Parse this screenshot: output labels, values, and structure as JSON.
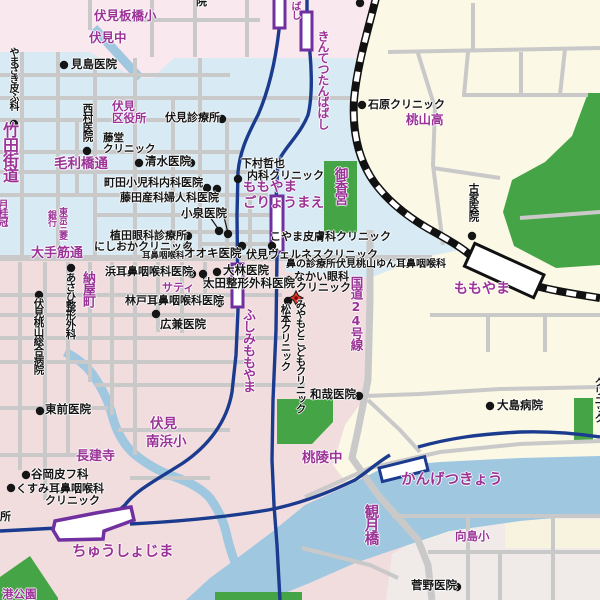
{
  "map": {
    "colors": {
      "purple_text": "#9B3397",
      "black_text": "#151515",
      "residential_blue": "#D8EAF3",
      "residential_pink": "#F1DDDE",
      "pink_light": "#F9E8EE",
      "cream": "#FBF8E6",
      "mukaijima_pale": "#F0EBE9",
      "water": "#9FC7E0",
      "park_green": "#45A546",
      "street_gray": "#C9C9C9",
      "railway_blue": "#1B3B8F",
      "station_purple": "#7030A0",
      "jr_black": "#111111",
      "marker_red": "#E5372E"
    },
    "marker": {
      "x": 296,
      "y": 298,
      "label": "destination"
    },
    "extra_dots": [
      [
        360,
        3
      ],
      [
        191,
        163
      ],
      [
        217,
        189
      ],
      [
        228,
        234
      ],
      [
        203,
        274
      ]
    ],
    "labels": [
      {
        "n": "fushimi-itabashi-elementary",
        "t": "伏見板橋小",
        "x": 94,
        "y": 10,
        "s": 12.5,
        "c": "p"
      },
      {
        "n": "fushimi-junior-high",
        "t": "伏見中",
        "x": 89,
        "y": 32,
        "s": 12.5,
        "c": "p"
      },
      {
        "n": "kintetsu-tambabashi-station",
        "t": "きんてつたんばばし",
        "x": 317,
        "y": 30,
        "s": 12,
        "c": "p",
        "v": 1
      },
      {
        "n": "tambabashi-station-partial",
        "t": "ばし",
        "x": 289,
        "y": 1,
        "s": 10,
        "c": "p",
        "v": 1
      },
      {
        "n": "momoyama-high-school",
        "t": "桃山高",
        "x": 406,
        "y": 114,
        "s": 12.5,
        "c": "p"
      },
      {
        "n": "takeda-kaido",
        "t": "竹田街道",
        "x": 1,
        "y": 122,
        "s": 16,
        "c": "p",
        "v": 1
      },
      {
        "n": "gekkeikan",
        "t": "月桂冠",
        "x": -4,
        "y": 199,
        "s": 10,
        "c": "p",
        "v": 1
      },
      {
        "n": "mourihashi-dori",
        "t": "毛利橋通",
        "x": 54,
        "y": 158,
        "s": 13.5,
        "c": "p"
      },
      {
        "n": "tokyo-mitsubishi-bank-line1",
        "t": "東京三菱",
        "x": 57,
        "y": 207,
        "s": 9,
        "c": "p",
        "v": 1
      },
      {
        "n": "tokyo-mitsubishi-bank-line2",
        "t": "銀行",
        "x": 46,
        "y": 210,
        "s": 9,
        "c": "p",
        "v": 1
      },
      {
        "n": "otesuji-dori",
        "t": "大手筋通",
        "x": 31,
        "y": 247,
        "s": 13,
        "c": "p"
      },
      {
        "n": "nayamachi",
        "t": "納屋町",
        "x": 81,
        "y": 271,
        "s": 13,
        "c": "p",
        "v": 1
      },
      {
        "n": "saty",
        "t": "サティ",
        "x": 162,
        "y": 282,
        "s": 11,
        "c": "p"
      },
      {
        "n": "fushimi-momoyama-station",
        "t": "ふしみももやま",
        "x": 241,
        "y": 308,
        "s": 13,
        "c": "p",
        "v": 1
      },
      {
        "n": "momoyama-goryomae-station-line1",
        "t": "ももやま",
        "x": 243,
        "y": 181,
        "s": 13.5,
        "c": "p"
      },
      {
        "n": "momoyama-goryomae-station-line2",
        "t": "ごりょうまえ",
        "x": 243,
        "y": 197,
        "s": 13.5,
        "c": "p"
      },
      {
        "n": "gokonomiya-shrine",
        "t": "御香宮",
        "x": 332,
        "y": 167,
        "s": 13.5,
        "c": "p",
        "v": 1
      },
      {
        "n": "route-24",
        "t": "国道24号線",
        "x": 349,
        "y": 276,
        "s": 12.5,
        "c": "p",
        "v": 1
      },
      {
        "n": "jr-momoyama-station",
        "t": "ももやま",
        "x": 454,
        "y": 282,
        "s": 14,
        "c": "p"
      },
      {
        "n": "toryo-junior-high",
        "t": "桃陵中",
        "x": 302,
        "y": 452,
        "s": 13.5,
        "c": "p"
      },
      {
        "n": "fushimi-minamihama-elementary-line1",
        "t": "伏見",
        "x": 150,
        "y": 418,
        "s": 13.5,
        "c": "p"
      },
      {
        "n": "fushimi-minamihama-elementary-line2",
        "t": "南浜小",
        "x": 146,
        "y": 436,
        "s": 13.5,
        "c": "p"
      },
      {
        "n": "chokenji-temple",
        "t": "長建寺",
        "x": 76,
        "y": 450,
        "s": 13,
        "c": "p"
      },
      {
        "n": "chushojima-station",
        "t": "ちゅうしょじま",
        "x": 72,
        "y": 545,
        "s": 14.5,
        "c": "p"
      },
      {
        "n": "kangetsukyo-station",
        "t": "かんげつきょう",
        "x": 401,
        "y": 473,
        "s": 14.5,
        "c": "p"
      },
      {
        "n": "kangetsu-bridge",
        "t": "観月橋",
        "x": 363,
        "y": 504,
        "s": 14.5,
        "c": "p",
        "v": 1
      },
      {
        "n": "mukaijima-elementary",
        "t": "向島小",
        "x": 455,
        "y": 531,
        "s": 11.5,
        "c": "p"
      },
      {
        "n": "minato-park",
        "t": "港公園",
        "x": 2,
        "y": 589,
        "s": 11.5,
        "c": "p"
      },
      {
        "n": "fushimi-ward-office-line1",
        "t": "伏見",
        "x": 112,
        "y": 101,
        "s": 11.5,
        "c": "p"
      },
      {
        "n": "fushimi-ward-office-line2",
        "t": "区役所",
        "x": 112,
        "y": 113,
        "s": 11.5,
        "c": "p"
      },
      {
        "n": "yamazaki-hifuka",
        "t": "やまざき皮ふ科",
        "x": 7,
        "y": 47,
        "s": 10,
        "c": "k",
        "v": 1,
        "dot": [
          14,
          124
        ]
      },
      {
        "n": "mishima-clinic",
        "t": "見島医院",
        "x": 71,
        "y": 59,
        "s": 11.5,
        "c": "k",
        "dot": [
          64,
          65
        ]
      },
      {
        "n": "nishimura-clinic",
        "t": "西村医院",
        "x": 82,
        "y": 103,
        "s": 10.5,
        "c": "k",
        "v": 1,
        "dot": [
          87,
          151
        ]
      },
      {
        "n": "fushimi-clinic",
        "t": "伏見診療所",
        "x": 165,
        "y": 112,
        "s": 11,
        "c": "k",
        "dot": [
          222,
          119
        ]
      },
      {
        "n": "todo-clinic-line1",
        "t": "藤堂",
        "x": 103,
        "y": 133,
        "s": 10.5,
        "c": "k"
      },
      {
        "n": "todo-clinic-line2",
        "t": "クリニック",
        "x": 103,
        "y": 144,
        "s": 10.5,
        "c": "k"
      },
      {
        "n": "shimizu-clinic",
        "t": "清水医院",
        "x": 145,
        "y": 156,
        "s": 11.5,
        "c": "k",
        "dot": [
          139,
          163
        ]
      },
      {
        "n": "machida-clinic",
        "t": "町田小児科内科医院",
        "x": 104,
        "y": 177,
        "s": 11,
        "c": "k",
        "dot": [
          207,
          188
        ]
      },
      {
        "n": "fujita-clinic",
        "t": "藤田産科婦人科医院",
        "x": 120,
        "y": 192,
        "s": 11,
        "c": "k"
      },
      {
        "n": "koizumi-clinic",
        "t": "小泉医院",
        "x": 181,
        "y": 208,
        "s": 11.5,
        "c": "k",
        "dot": [
          219,
          231
        ]
      },
      {
        "n": "ueda-eye-clinic",
        "t": "植田眼科診療所",
        "x": 110,
        "y": 230,
        "s": 11,
        "c": "k",
        "dot": [
          188,
          236
        ]
      },
      {
        "n": "nishioka-clinic",
        "t": "にしおかクリニック",
        "x": 94,
        "y": 241,
        "s": 11,
        "c": "k",
        "dot": [
          187,
          246
        ]
      },
      {
        "n": "ohki-ent-line1",
        "t": "耳鼻咽喉科",
        "x": 142,
        "y": 252,
        "s": 8.5,
        "c": "k"
      },
      {
        "n": "ohki-ent-line2",
        "t": "オオキ医院",
        "x": 184,
        "y": 248,
        "s": 11.5,
        "c": "k"
      },
      {
        "n": "shimomura-clinic-line1",
        "t": "下村哲也",
        "x": 241,
        "y": 158,
        "s": 11,
        "c": "k",
        "dot": [
          238,
          179
        ]
      },
      {
        "n": "shimomura-clinic-line2",
        "t": "内科クリニック",
        "x": 247,
        "y": 170,
        "s": 11,
        "c": "k"
      },
      {
        "n": "koyama-derma-clinic",
        "t": "こやま皮膚科クリニック",
        "x": 270,
        "y": 231,
        "s": 11,
        "c": "k",
        "dot": [
          272,
          246
        ]
      },
      {
        "n": "fushimi-wellness-clinic",
        "t": "伏見ヴェルネスクリニック",
        "x": 246,
        "y": 249,
        "s": 11,
        "c": "k",
        "dot": [
          242,
          246
        ]
      },
      {
        "n": "hana-no-shinryojo-yun-ent",
        "t": "鼻の診療所伏見桃山ゆん耳鼻咽喉科",
        "x": 286,
        "y": 260,
        "s": 10,
        "c": "k"
      },
      {
        "n": "nakai-eye-line1",
        "t": "なかい眼科",
        "x": 294,
        "y": 271,
        "s": 11,
        "c": "k",
        "dot": [
          289,
          280
        ]
      },
      {
        "n": "nakai-eye-line2",
        "t": "クリニック",
        "x": 296,
        "y": 282,
        "s": 11,
        "c": "k"
      },
      {
        "n": "matsumoto-clinic",
        "t": "松本クリニック",
        "x": 280,
        "y": 304,
        "s": 10.5,
        "c": "k",
        "v": 1,
        "dot": [
          288,
          301
        ]
      },
      {
        "n": "miyamoto-kids-clinic",
        "t": "みやもとこどもクリニック",
        "x": 295,
        "y": 299,
        "s": 10.5,
        "c": "k",
        "v": 1
      },
      {
        "n": "hama-ent-clinic",
        "t": "浜耳鼻咽喉科医院",
        "x": 105,
        "y": 266,
        "s": 11,
        "c": "k",
        "dot": [
          192,
          274
        ]
      },
      {
        "n": "obayashi-clinic",
        "t": "大林医院",
        "x": 223,
        "y": 265,
        "s": 11.5,
        "c": "k",
        "dot": [
          217,
          272
        ]
      },
      {
        "n": "ota-seikei-clinic",
        "t": "太田整形外科医院",
        "x": 203,
        "y": 278,
        "s": 11.5,
        "c": "k"
      },
      {
        "n": "hayashido-ent-clinic",
        "t": "林戸耳鼻咽喉科医院",
        "x": 125,
        "y": 295,
        "s": 11,
        "c": "k",
        "dot": [
          220,
          303
        ]
      },
      {
        "n": "hirokane-clinic",
        "t": "広兼医院",
        "x": 160,
        "y": 319,
        "s": 11.5,
        "c": "k",
        "dot": [
          156,
          314
        ]
      },
      {
        "n": "asahi-seikei-clinic",
        "t": "あさひ整形外科",
        "x": 65,
        "y": 272,
        "s": 10.5,
        "c": "k",
        "v": 1,
        "dot": [
          71,
          268
        ]
      },
      {
        "n": "fushimi-momoyama-sogo-hospital",
        "t": "伏見桃山総合病院",
        "x": 33,
        "y": 298,
        "s": 10.5,
        "c": "k",
        "v": 1,
        "dot": [
          39,
          295
        ]
      },
      {
        "n": "ishihara-clinic",
        "t": "石原クリニック",
        "x": 368,
        "y": 99,
        "s": 11,
        "c": "k",
        "dot": [
          362,
          105
        ]
      },
      {
        "n": "furuya-clinic",
        "t": "古家医院",
        "x": 468,
        "y": 183,
        "s": 10.5,
        "c": "k",
        "v": 1,
        "dot": [
          472,
          236
        ]
      },
      {
        "n": "wakaya-clinic",
        "t": "和哉医院",
        "x": 310,
        "y": 389,
        "s": 11.5,
        "c": "k",
        "dot": [
          359,
          396
        ]
      },
      {
        "n": "oshima-hospital",
        "t": "大島病院",
        "x": 497,
        "y": 400,
        "s": 11.5,
        "c": "k",
        "dot": [
          490,
          406
        ]
      },
      {
        "n": "tozen-clinic",
        "t": "東前医院",
        "x": 45,
        "y": 404,
        "s": 11.5,
        "c": "k",
        "dot": [
          40,
          411
        ]
      },
      {
        "n": "tanioka-hifuka",
        "t": "谷岡皮フ科",
        "x": 31,
        "y": 469,
        "s": 11.5,
        "c": "k",
        "dot": [
          26,
          475
        ]
      },
      {
        "n": "kusumi-ent-line1",
        "t": "くすみ耳鼻咽喉科",
        "x": 16,
        "y": 483,
        "s": 11,
        "c": "k",
        "dot": [
          11,
          488
        ]
      },
      {
        "n": "kusumi-ent-line2",
        "t": "クリニック",
        "x": 45,
        "y": 495,
        "s": 11,
        "c": "k"
      },
      {
        "n": "sugano-clinic",
        "t": "菅野医院",
        "x": 411,
        "y": 580,
        "s": 11.5,
        "c": "k",
        "dot": [
          457,
          587
        ]
      },
      {
        "n": "shinryojo-partial",
        "t": "所",
        "x": 0,
        "y": 511,
        "s": 11,
        "c": "k"
      },
      {
        "n": "clinic-partial-top",
        "t": "院",
        "x": 196,
        "y": -4,
        "s": 11,
        "c": "k"
      },
      {
        "n": "clinic-partial-right",
        "t": "クリニック",
        "x": 592,
        "y": 377,
        "s": 10,
        "c": "k",
        "v": 1
      }
    ]
  }
}
